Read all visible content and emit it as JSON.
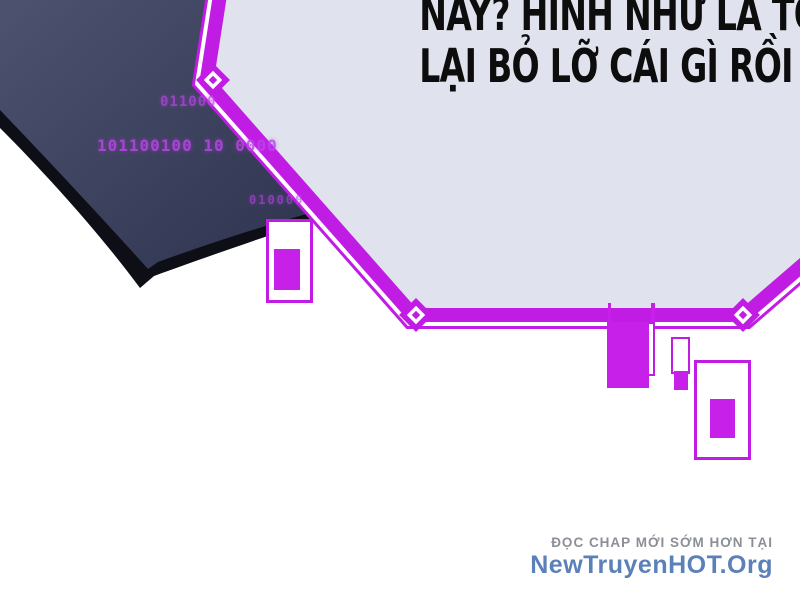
{
  "dialogue": {
    "line1": "NÀY? HÌNH NHƯ LÀ TÔI",
    "line2": "LẠI BỎ LỠ CÁI GÌ RỒI"
  },
  "code_overlay": {
    "row1": "011000",
    "row2": "101100100 10 0000",
    "row3": "010000"
  },
  "footer": {
    "tagline": "ĐỌC CHAP MỚI SỚM HƠN TẠI",
    "site_name": "NewTruyenHOT.Org"
  },
  "colors": {
    "accent_magenta": "#c11ce4",
    "hud_fill_magenta": "#c620e9",
    "bubble_fill": "#e0e3ed",
    "wing_light": "#4d536e",
    "wing_dark": "#2e3450",
    "wing_edge_black": "#0d0e16",
    "code_text": "#b946e8",
    "footer_gray": "#8b8f96",
    "footer_blue": "#5c80b8",
    "dialogue_black": "#0d0d0d"
  }
}
